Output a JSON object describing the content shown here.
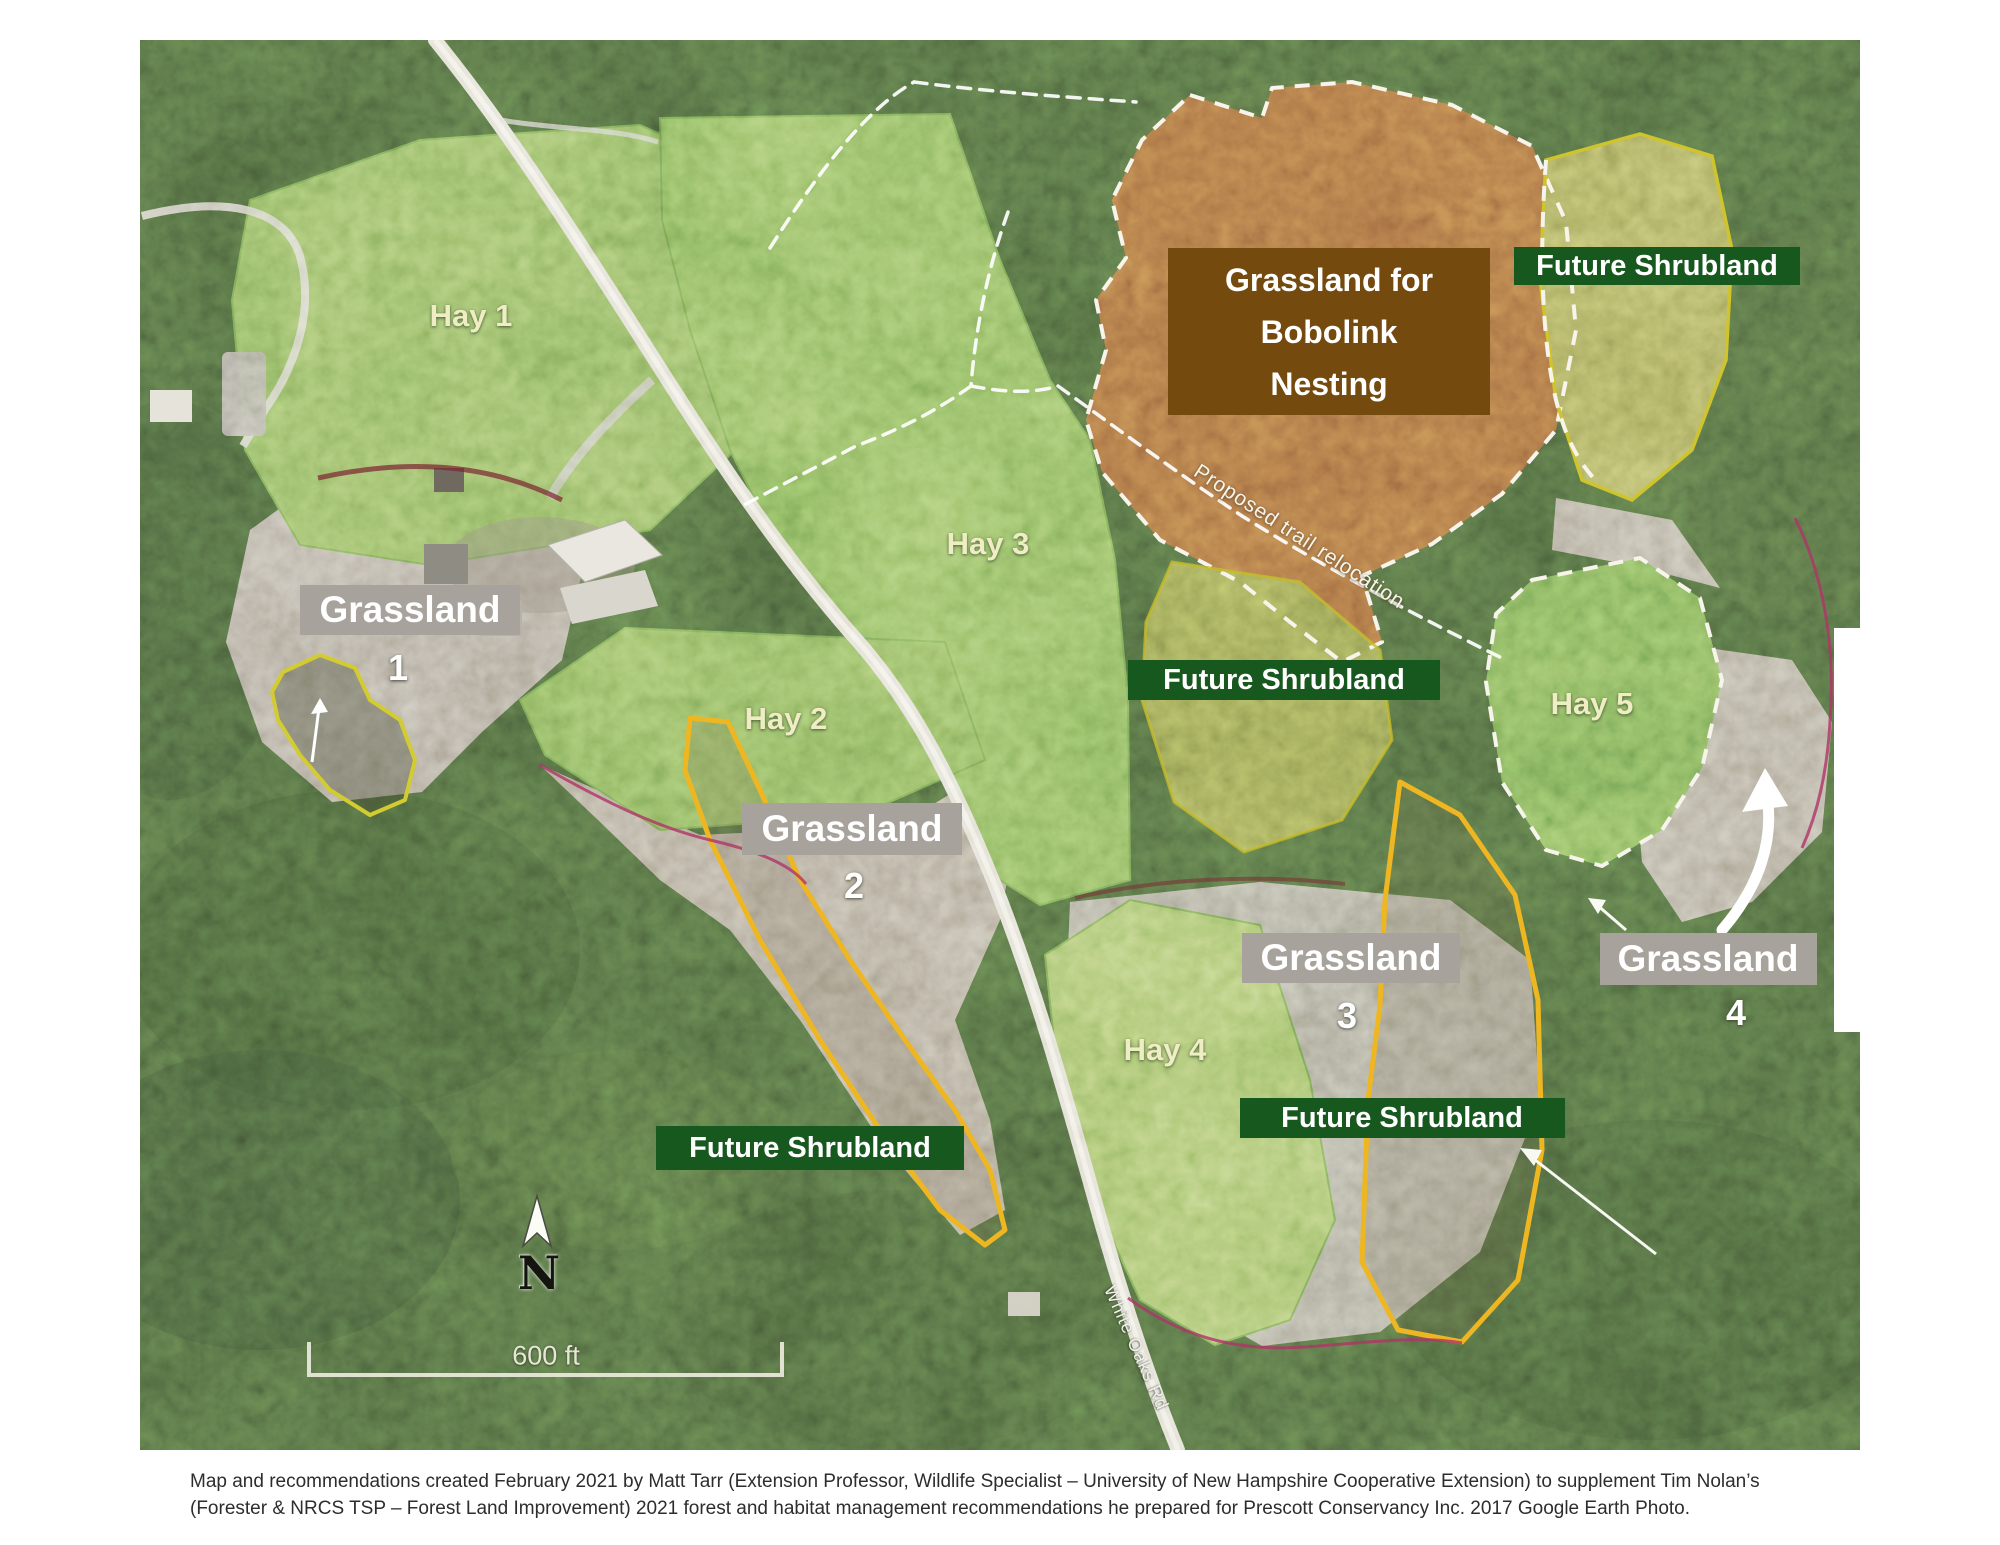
{
  "map": {
    "hay_labels": [
      {
        "label": "Hay 1",
        "cx": 471,
        "cy": 316
      },
      {
        "label": "Hay 2",
        "cx": 786,
        "cy": 719
      },
      {
        "label": "Hay 3",
        "cx": 988,
        "cy": 544
      },
      {
        "label": "Hay 4",
        "cx": 1165,
        "cy": 1050
      },
      {
        "label": "Hay 5",
        "cx": 1592,
        "cy": 704
      }
    ],
    "grassland_labels": [
      {
        "label": "Grassland",
        "number": "1",
        "cx": 410,
        "cy": 610,
        "w": 220,
        "h": 50,
        "ncx": 398,
        "ncy": 668
      },
      {
        "label": "Grassland",
        "number": "2",
        "cx": 852,
        "cy": 829,
        "w": 220,
        "h": 52,
        "ncx": 854,
        "ncy": 886
      },
      {
        "label": "Grassland",
        "number": "3",
        "cx": 1351,
        "cy": 958,
        "w": 218,
        "h": 50,
        "ncx": 1347,
        "ncy": 1016
      },
      {
        "label": "Grassland",
        "number": "4",
        "cx": 1708,
        "cy": 959,
        "w": 217,
        "h": 52,
        "ncx": 1736,
        "ncy": 1013
      }
    ],
    "future_shrubland_labels": [
      {
        "label": "Future Shrubland",
        "cx": 1657,
        "cy": 266,
        "w": 286,
        "h": 38
      },
      {
        "label": "Future Shrubland",
        "cx": 1284,
        "cy": 680,
        "w": 312,
        "h": 40
      },
      {
        "label": "Future Shrubland",
        "cx": 1402,
        "cy": 1118,
        "w": 325,
        "h": 40
      },
      {
        "label": "Future Shrubland",
        "cx": 810,
        "cy": 1148,
        "w": 308,
        "h": 44
      }
    ],
    "bobolink_label": {
      "lines": [
        "Grassland for",
        "Bobolink",
        "Nesting"
      ]
    },
    "trail_label": {
      "text": "Proposed trail relocation"
    },
    "road_label": {
      "text": "White Oaks Rd"
    },
    "north": {
      "label": "N"
    },
    "scale": {
      "label": "600 ft"
    },
    "colors": {
      "grassland_label_bg": "#a7a29b",
      "future_shrubland_bg": "#17581e",
      "bobolink_bg": "#754a0e",
      "bobolink_field_brown": "#8b5832",
      "hay_field_green": "#70a04c",
      "shrub_outline_yellow": "#eeb722",
      "boundary_dash_white": "#f6f4eb",
      "magenta_edge": "#b03468"
    }
  },
  "caption": {
    "line1": "Map and recommendations created February 2021 by Matt Tarr (Extension Professor, Wildlife Specialist – University of New Hampshire Cooperative Extension) to supplement Tim Nolan’s",
    "line2": "(Forester & NRCS TSP – Forest Land Improvement) 2021 forest and habitat management recommendations he prepared for Prescott Conservancy Inc. 2017 Google Earth Photo."
  }
}
